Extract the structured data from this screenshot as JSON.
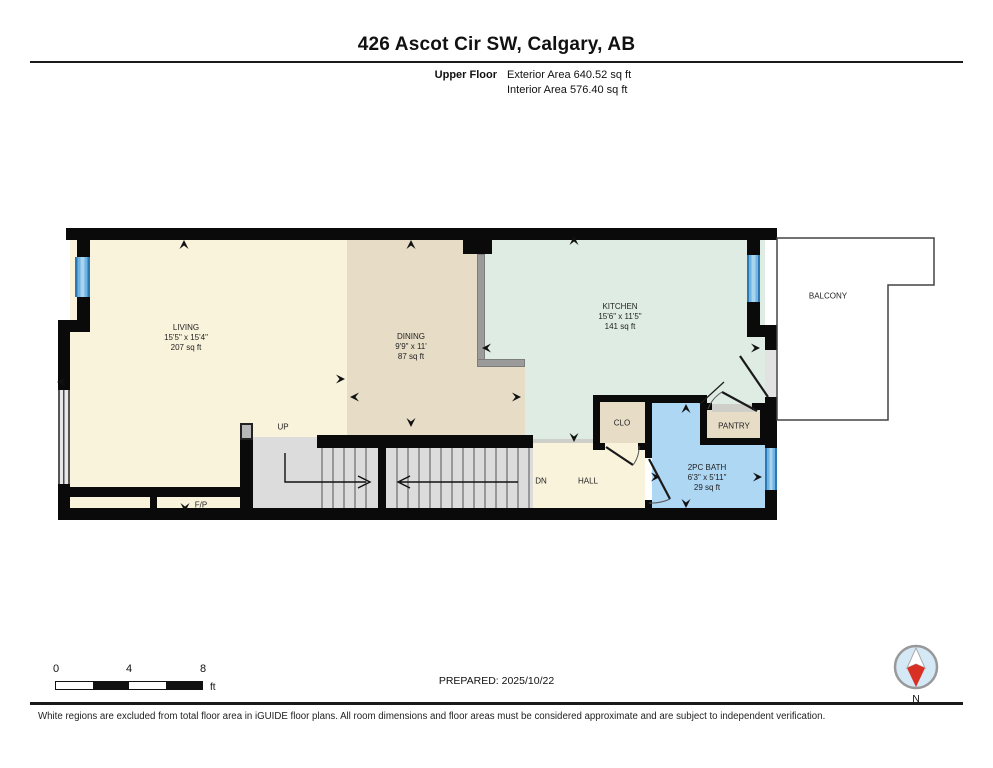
{
  "header": {
    "title": "426 Ascot Cir SW, Calgary, AB",
    "floor_label": "Upper Floor",
    "exterior_area": "Exterior Area 640.52 sq ft",
    "interior_area": "Interior Area 576.40 sq ft"
  },
  "rooms": {
    "living": {
      "name": "LIVING",
      "dims": "15'5\" x 15'4\"",
      "area": "207 sq ft"
    },
    "dining": {
      "name": "DINING",
      "dims": "9'9\" x 11'",
      "area": "87 sq ft"
    },
    "kitchen": {
      "name": "KITCHEN",
      "dims": "15'6\" x 11'5\"",
      "area": "141 sq ft"
    },
    "bath": {
      "name": "2PC BATH",
      "dims": "6'3\" x 5'11\"",
      "area": "29 sq ft"
    }
  },
  "labels": {
    "balcony": "BALCONY",
    "closet": "CLO",
    "pantry": "PANTRY",
    "hall": "HALL",
    "down": "DN",
    "up": "UP",
    "fireplace": "F/P"
  },
  "scale_bar": {
    "ticks": [
      "0",
      "4",
      "8"
    ],
    "unit": "ft"
  },
  "footer": {
    "prepared": "PREPARED: 2025/10/22",
    "disclaimer": "White regions are excluded from total floor area in iGUIDE floor plans. All room dimensions and floor areas must be considered approximate and are subject to independent verification.",
    "compass_label": "N"
  },
  "colors": {
    "living": "#faf3dc",
    "dining": "#e7ddc7",
    "kitchen": "#dfece4",
    "bath": "#aed7f4",
    "stairs": "#dcdcdc",
    "hall": "#faf3dc",
    "closet": "#e7ddc7",
    "pantry": "#e7ddc7",
    "window_blue": "#4a9fd4",
    "wall_black": "#0a0a0a",
    "compass_red": "#d93025"
  }
}
